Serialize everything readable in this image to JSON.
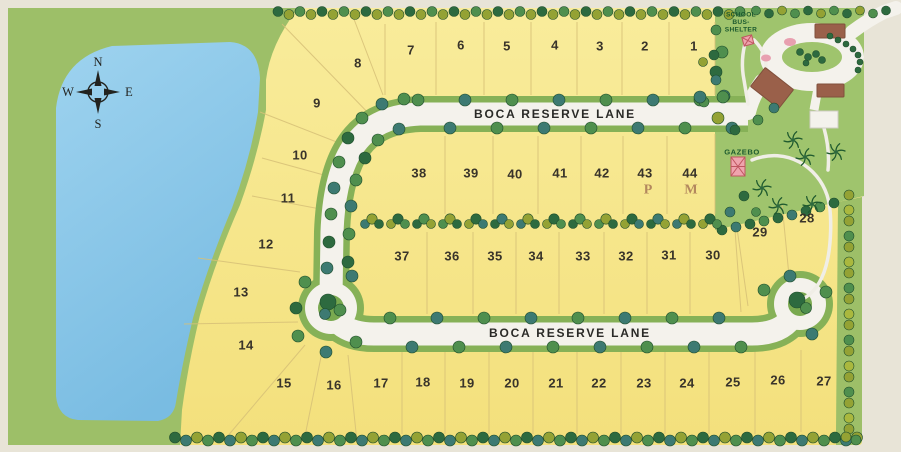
{
  "canvas": {
    "width": 901,
    "height": 452
  },
  "streets": {
    "upper": {
      "label": "BOCA RESERVE LANE"
    },
    "lower": {
      "label": "BOCA RESERVE LANE"
    }
  },
  "compass": {
    "north": "N",
    "south": "S",
    "east": "E",
    "west": "W"
  },
  "poi": {
    "school_bus_shelter": [
      "SCHOOL",
      "BUS-",
      "SHELTER"
    ],
    "gazebo": "GAZEBO"
  },
  "markers": [
    {
      "label": "P"
    },
    {
      "label": "M"
    }
  ],
  "lots": [
    {
      "n": 1,
      "x": 694,
      "y": 46
    },
    {
      "n": 2,
      "x": 645,
      "y": 46
    },
    {
      "n": 3,
      "x": 600,
      "y": 46
    },
    {
      "n": 4,
      "x": 555,
      "y": 45
    },
    {
      "n": 5,
      "x": 507,
      "y": 46
    },
    {
      "n": 6,
      "x": 461,
      "y": 45
    },
    {
      "n": 7,
      "x": 411,
      "y": 50
    },
    {
      "n": 8,
      "x": 358,
      "y": 63
    },
    {
      "n": 9,
      "x": 317,
      "y": 103
    },
    {
      "n": 10,
      "x": 300,
      "y": 155
    },
    {
      "n": 11,
      "x": 288,
      "y": 198
    },
    {
      "n": 12,
      "x": 266,
      "y": 244
    },
    {
      "n": 13,
      "x": 241,
      "y": 292
    },
    {
      "n": 14,
      "x": 246,
      "y": 345
    },
    {
      "n": 15,
      "x": 284,
      "y": 383
    },
    {
      "n": 16,
      "x": 334,
      "y": 385
    },
    {
      "n": 17,
      "x": 381,
      "y": 383
    },
    {
      "n": 18,
      "x": 423,
      "y": 382
    },
    {
      "n": 19,
      "x": 467,
      "y": 383
    },
    {
      "n": 20,
      "x": 512,
      "y": 383
    },
    {
      "n": 21,
      "x": 556,
      "y": 383
    },
    {
      "n": 22,
      "x": 599,
      "y": 383
    },
    {
      "n": 23,
      "x": 644,
      "y": 383
    },
    {
      "n": 24,
      "x": 687,
      "y": 383
    },
    {
      "n": 25,
      "x": 733,
      "y": 382
    },
    {
      "n": 26,
      "x": 778,
      "y": 380
    },
    {
      "n": 27,
      "x": 824,
      "y": 381
    },
    {
      "n": 28,
      "x": 807,
      "y": 218
    },
    {
      "n": 29,
      "x": 760,
      "y": 232
    },
    {
      "n": 30,
      "x": 713,
      "y": 255
    },
    {
      "n": 31,
      "x": 669,
      "y": 255
    },
    {
      "n": 32,
      "x": 626,
      "y": 256
    },
    {
      "n": 33,
      "x": 583,
      "y": 256
    },
    {
      "n": 34,
      "x": 536,
      "y": 256
    },
    {
      "n": 35,
      "x": 495,
      "y": 256
    },
    {
      "n": 36,
      "x": 452,
      "y": 256
    },
    {
      "n": 37,
      "x": 402,
      "y": 256
    },
    {
      "n": 38,
      "x": 419,
      "y": 173
    },
    {
      "n": 39,
      "x": 471,
      "y": 173
    },
    {
      "n": 40,
      "x": 515,
      "y": 174
    },
    {
      "n": 41,
      "x": 560,
      "y": 173
    },
    {
      "n": 42,
      "x": 602,
      "y": 173
    },
    {
      "n": 43,
      "x": 645,
      "y": 173
    },
    {
      "n": 44,
      "x": 690,
      "y": 173
    }
  ],
  "colors": {
    "background": "#e8e4d7",
    "lot": "#f8e98e",
    "grass": "#9dbf68",
    "lawn": "#9fc46d",
    "verge": "#86b157",
    "island": "#79a94f",
    "lake_top": "#9ed3ef",
    "lake_bottom": "#79bce2",
    "road": "#f4f2ec",
    "building": "#9a604a",
    "shelter_pink": "#efa3ad",
    "trees": {
      "dark": "#2d6a3f",
      "mid": "#4f8f4e",
      "teal": "#3d7a72",
      "olive": "#94a234",
      "lime": "#aab83e"
    }
  },
  "tree_rows": [
    {
      "axis": "h",
      "y": 13,
      "x0": 278,
      "x1": 748,
      "step": 11,
      "r": 5,
      "jit": 1.5,
      "palette": [
        "dark",
        "olive",
        "mid",
        "olive"
      ]
    },
    {
      "axis": "h",
      "y": 12,
      "x0": 756,
      "x1": 892,
      "step": 13,
      "r": 4.5,
      "jit": 1.5,
      "palette": [
        "mid",
        "dark",
        "olive"
      ]
    },
    {
      "axis": "h",
      "y": 439,
      "x0": 175,
      "x1": 857,
      "step": 11,
      "r": 5.5,
      "jit": 1.5,
      "palette": [
        "dark",
        "teal",
        "olive",
        "mid"
      ]
    },
    {
      "axis": "v",
      "x": 849,
      "y0": 196,
      "y1": 430,
      "step": 13,
      "r": 5,
      "jit": 1,
      "palette": [
        "olive",
        "lime",
        "olive",
        "mid"
      ]
    },
    {
      "axis": "h",
      "y": 100,
      "x0": 418,
      "x1": 700,
      "step": 47,
      "r": 6,
      "jit": 0,
      "palette": [
        "mid",
        "teal"
      ]
    },
    {
      "axis": "h",
      "y": 128,
      "x0": 450,
      "x1": 732,
      "step": 47,
      "r": 6,
      "jit": 0,
      "palette": [
        "teal",
        "mid"
      ]
    },
    {
      "axis": "h",
      "y": 318,
      "x0": 390,
      "x1": 765,
      "step": 47,
      "r": 6,
      "jit": 0,
      "palette": [
        "mid",
        "teal"
      ]
    },
    {
      "axis": "h",
      "y": 347,
      "x0": 412,
      "x1": 742,
      "step": 47,
      "r": 6,
      "jit": 0,
      "palette": [
        "teal",
        "mid"
      ]
    }
  ],
  "tree_points": [
    [
      404,
      99,
      "mid"
    ],
    [
      382,
      104,
      "teal"
    ],
    [
      362,
      118,
      "mid"
    ],
    [
      348,
      138,
      "dark"
    ],
    [
      339,
      162,
      "mid"
    ],
    [
      334,
      188,
      "teal"
    ],
    [
      331,
      214,
      "mid"
    ],
    [
      329,
      242,
      "dark"
    ],
    [
      327,
      268,
      "teal"
    ],
    [
      399,
      129,
      "teal"
    ],
    [
      378,
      140,
      "mid"
    ],
    [
      365,
      158,
      "dark"
    ],
    [
      356,
      180,
      "mid"
    ],
    [
      351,
      206,
      "teal"
    ],
    [
      349,
      234,
      "mid"
    ],
    [
      348,
      262,
      "dark"
    ],
    [
      305,
      282,
      "mid"
    ],
    [
      352,
      276,
      "teal"
    ],
    [
      296,
      308,
      "dark"
    ],
    [
      298,
      336,
      "mid"
    ],
    [
      326,
      352,
      "teal"
    ],
    [
      356,
      342,
      "mid"
    ],
    [
      328,
      302,
      "dark",
      8
    ],
    [
      340,
      310,
      "mid",
      6
    ],
    [
      325,
      314,
      "teal",
      5.5
    ],
    [
      764,
      290,
      "mid"
    ],
    [
      790,
      276,
      "teal"
    ],
    [
      826,
      292,
      "mid"
    ],
    [
      812,
      334,
      "teal"
    ],
    [
      797,
      300,
      "dark",
      8
    ],
    [
      806,
      308,
      "mid",
      5.5
    ],
    [
      722,
      52,
      "mid"
    ],
    [
      716,
      72,
      "dark"
    ],
    [
      724,
      96,
      "teal"
    ],
    [
      718,
      118,
      "olive"
    ],
    [
      704,
      102,
      "mid",
      5
    ],
    [
      735,
      130,
      "dark",
      5
    ],
    [
      703,
      62,
      "olive",
      4.5
    ],
    [
      758,
      120,
      "mid",
      5
    ],
    [
      774,
      108,
      "teal",
      5
    ],
    [
      846,
      44,
      "dark",
      3
    ],
    [
      853,
      49,
      "dark",
      3
    ],
    [
      858,
      55,
      "dark",
      3
    ],
    [
      860,
      62,
      "dark",
      3
    ],
    [
      858,
      70,
      "dark",
      3
    ],
    [
      838,
      40,
      "dark",
      3
    ],
    [
      830,
      36,
      "dark",
      3
    ],
    [
      800,
      52,
      "dark",
      3.5
    ],
    [
      808,
      57,
      "dark",
      3.5
    ],
    [
      816,
      54,
      "dark",
      3.5
    ],
    [
      822,
      60,
      "dark",
      3.5
    ],
    [
      806,
      63,
      "dark",
      3
    ],
    [
      722,
      230,
      "dark",
      5
    ],
    [
      736,
      227,
      "teal",
      5
    ],
    [
      750,
      224,
      "dark",
      5
    ],
    [
      764,
      221,
      "mid",
      5
    ],
    [
      778,
      218,
      "dark",
      5
    ],
    [
      792,
      215,
      "teal",
      5
    ],
    [
      806,
      211,
      "dark",
      5
    ],
    [
      820,
      207,
      "mid",
      5
    ],
    [
      834,
      203,
      "dark",
      5
    ],
    [
      744,
      196,
      "dark",
      5
    ],
    [
      730,
      212,
      "teal",
      5
    ],
    [
      756,
      212,
      "mid",
      4.5
    ],
    [
      700,
      97,
      "teal"
    ],
    [
      723,
      97,
      "mid"
    ],
    [
      846,
      437,
      "olive",
      5
    ],
    [
      856,
      440,
      "mid",
      5
    ],
    [
      716,
      30,
      "mid",
      5
    ],
    [
      714,
      55,
      "dark",
      5
    ],
    [
      716,
      80,
      "teal",
      5
    ]
  ],
  "hedge_row": {
    "y": 221,
    "x0": 372,
    "x1": 734,
    "step": 26,
    "palettes": [
      "teal",
      "olive",
      "dark",
      "mid",
      "olive",
      "dark"
    ]
  },
  "palms": [
    [
      793,
      140
    ],
    [
      805,
      157
    ],
    [
      762,
      188
    ],
    [
      778,
      206
    ],
    [
      812,
      204
    ],
    [
      836,
      152
    ]
  ]
}
